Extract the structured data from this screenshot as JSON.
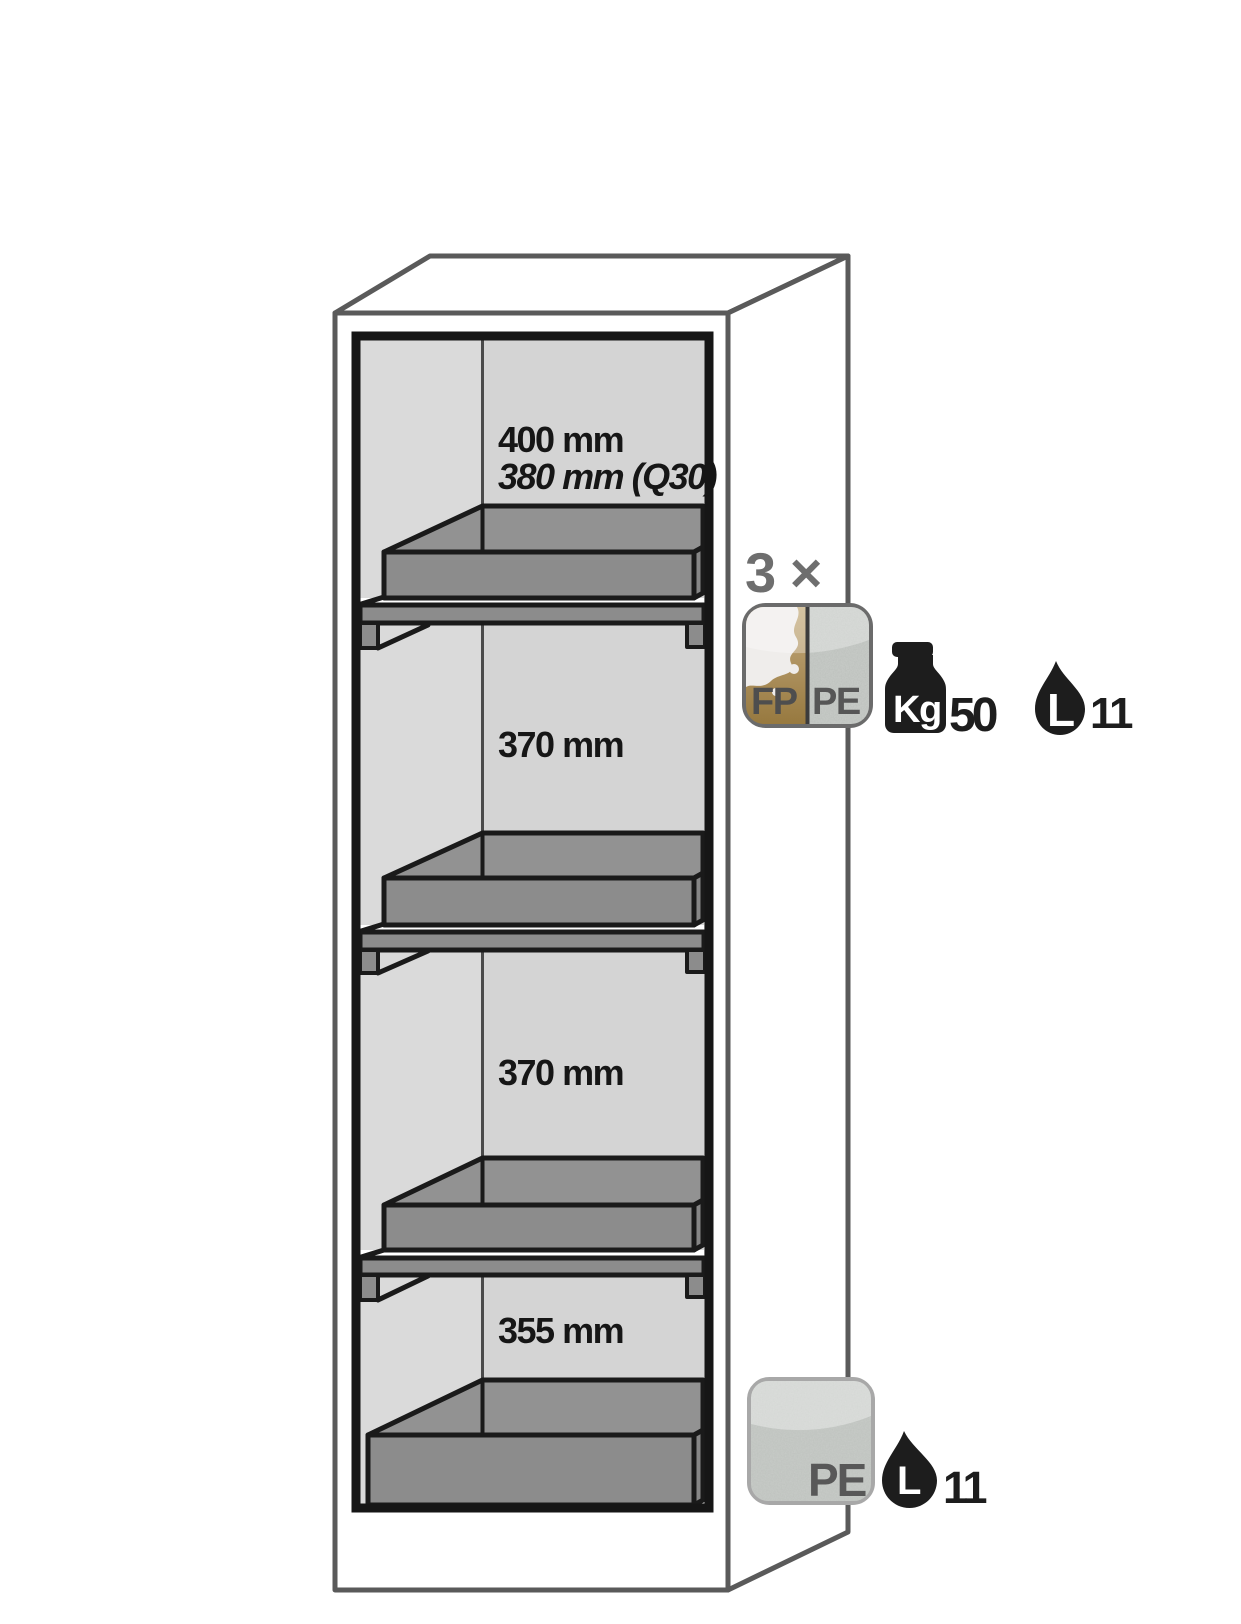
{
  "diagram_title": "safety-cabinet-interior-schematic",
  "compartments": [
    {
      "line1": "400 mm",
      "line2": "380 mm (Q30)"
    },
    {
      "line1": "370 mm"
    },
    {
      "line1": "370 mm"
    },
    {
      "line1": "355 mm"
    }
  ],
  "shelf_annotation": {
    "count": "3 ×",
    "fp_label": "FP",
    "pe_label": "PE",
    "weight_unit": "Kg",
    "weight_value": "50",
    "volume_unit": "L",
    "volume_value": "11"
  },
  "sump_annotation": {
    "pe_label": "PE",
    "volume_unit": "L",
    "volume_value": "11"
  },
  "icons": {
    "weight": "kettlebell-weight-icon",
    "volume": "liquid-drop-icon",
    "tray_material": "fp-pe-split-tray-icon",
    "sump_material": "pe-sump-tray-icon"
  },
  "colors": {
    "cabinet_outline": "#5a5a5a",
    "interior_wall_left": "#dadada",
    "interior_wall_back": "#d4d4d4",
    "tray_gray": "#8c8c8c",
    "outline_black": "#1a1a1a",
    "fp_gold": "#ae9260",
    "pe_speckle_gray": "#c9cdc9",
    "muted_label_gray": "#6e6e6e",
    "icon_black": "#1d1d1d"
  }
}
